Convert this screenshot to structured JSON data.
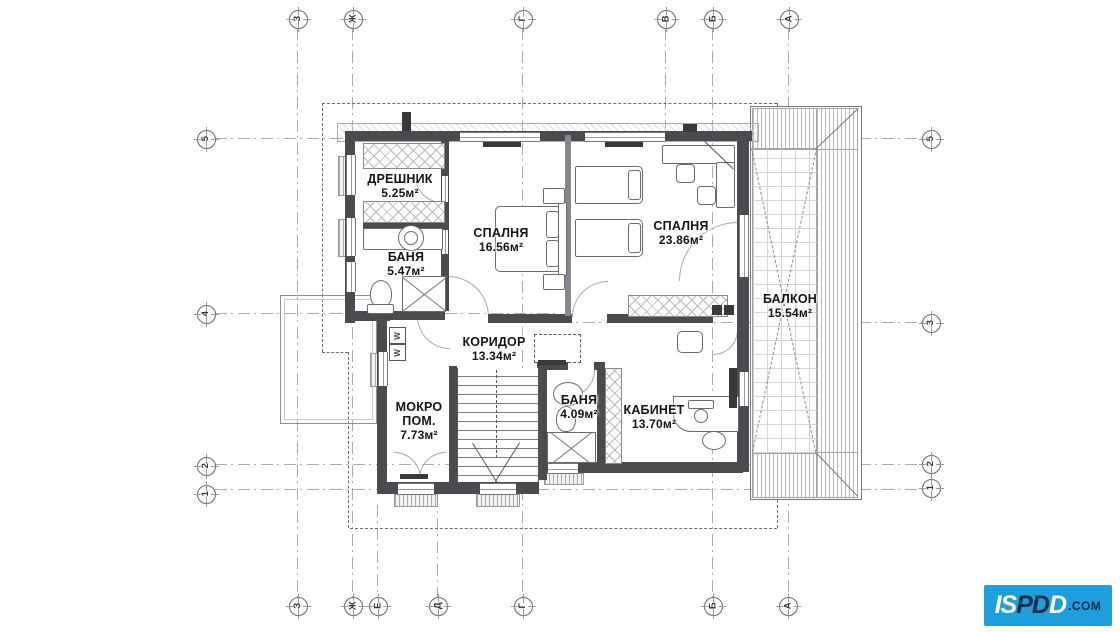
{
  "rooms": [
    {
      "name": "ДРЕШНИК",
      "area": "5.25м²"
    },
    {
      "name": "БАНЯ",
      "area": "5.47м²"
    },
    {
      "name": "СПАЛНЯ",
      "area": "16.56м²"
    },
    {
      "name": "СПАЛНЯ",
      "area": "23.86м²"
    },
    {
      "name": "БАЛКОН",
      "area": "15.54м²"
    },
    {
      "name": "КОРИДОР",
      "area": "13.34м²"
    },
    {
      "name": "МОКРО ПОМ.",
      "area": "7.73м²"
    },
    {
      "name": "БАНЯ",
      "area": "4.09м²"
    },
    {
      "name": "КАБИНЕТ",
      "area": "13.70м²"
    }
  ],
  "grid": {
    "top": [
      {
        "label": "З",
        "x": 297
      },
      {
        "label": "Ж",
        "x": 352
      },
      {
        "label": "Г",
        "x": 522
      },
      {
        "label": "В",
        "x": 665
      },
      {
        "label": "Б",
        "x": 712
      },
      {
        "label": "А",
        "x": 788
      }
    ],
    "bottom": [
      {
        "label": "З",
        "x": 297
      },
      {
        "label": "Ж",
        "x": 352
      },
      {
        "label": "Е",
        "x": 377
      },
      {
        "label": "Д",
        "x": 437
      },
      {
        "label": "Г",
        "x": 522
      },
      {
        "label": "Б",
        "x": 712
      },
      {
        "label": "А",
        "x": 787
      }
    ],
    "left": [
      {
        "label": "5",
        "y": 138
      },
      {
        "label": "4",
        "y": 313
      },
      {
        "label": "2",
        "y": 465
      },
      {
        "label": "1",
        "y": 493
      }
    ],
    "right": [
      {
        "label": "5",
        "y": 138
      },
      {
        "label": "3",
        "y": 322
      },
      {
        "label": "2",
        "y": 463
      },
      {
        "label": "1",
        "y": 487
      }
    ]
  },
  "appliances": {
    "washer": "W"
  },
  "logo": {
    "letters": [
      {
        "ch": "I",
        "tone": "light"
      },
      {
        "ch": "S",
        "tone": "light"
      },
      {
        "ch": "P",
        "tone": "dark"
      },
      {
        "ch": "D",
        "tone": "dark"
      },
      {
        "ch": "D",
        "tone": "light"
      }
    ],
    "suffix": ".COM",
    "bg": "#1E9FDD",
    "dark": "#0D2C46",
    "light": "#FFFFFF"
  }
}
